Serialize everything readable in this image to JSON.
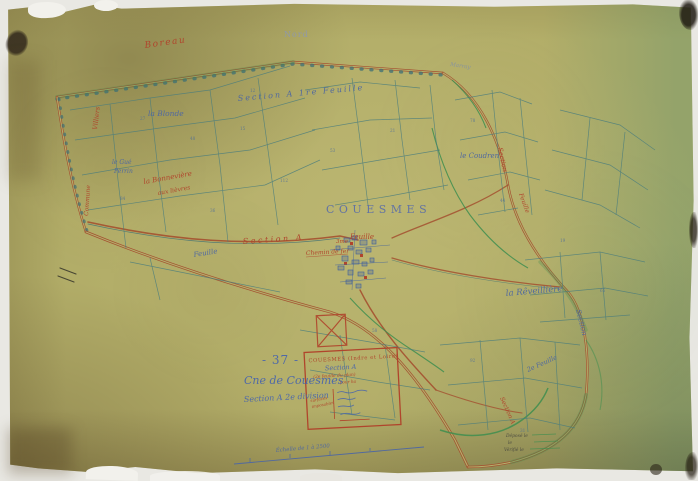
{
  "scan": {
    "compass": "Nord",
    "scale_text": "Échelle de 1 à 2500",
    "deposit_notes": [
      "Déposé le",
      "le",
      "Vérifié le"
    ]
  },
  "title_block": {
    "number": "- 37 -",
    "commune": "Cne de Couesmes",
    "section": "Section A 2e division"
  },
  "cartouche": {
    "header": "COUESMES (Indre et Loire)",
    "section_line": "Section A",
    "feuille_line": "(2e feuille du plan)",
    "per_ha": "pour ha",
    "side_note_1": "surfaces",
    "side_note_2": "imposables"
  },
  "place_labels": {
    "boreau": "Boreau",
    "villiers": "Villiers",
    "commune_edge": "Commune",
    "la_blonde": "la Blonde",
    "section_a_1re_feuille": "Section  A   1re Feuille",
    "le_gue": "le Gué",
    "perrin": "Perrin",
    "bonneviere": "la Bonnevière",
    "aux_lievres": "aux lièvres",
    "section_a_mid": "Section   A",
    "trois_me": "3me",
    "feuille_mid": "Feuille",
    "chemin_de_fer": "Chemin de fer",
    "couesmes_town": "COUESMES",
    "feuille_village": "Feuille",
    "le_coudren": "le Coudren",
    "marray": "Marray",
    "section_right": "Section",
    "feuille_right": "Feuille",
    "la_reveilliere": "la Rêveillière",
    "section_se": "Section",
    "feuille_2e": "2e Feuille",
    "section_a_br": "Section A"
  },
  "parcel_numbers": [
    "27",
    "48",
    "15",
    "84",
    "36",
    "112",
    "53",
    "21",
    "78",
    "44",
    "19",
    "65",
    "92",
    "31",
    "58",
    "12"
  ]
}
